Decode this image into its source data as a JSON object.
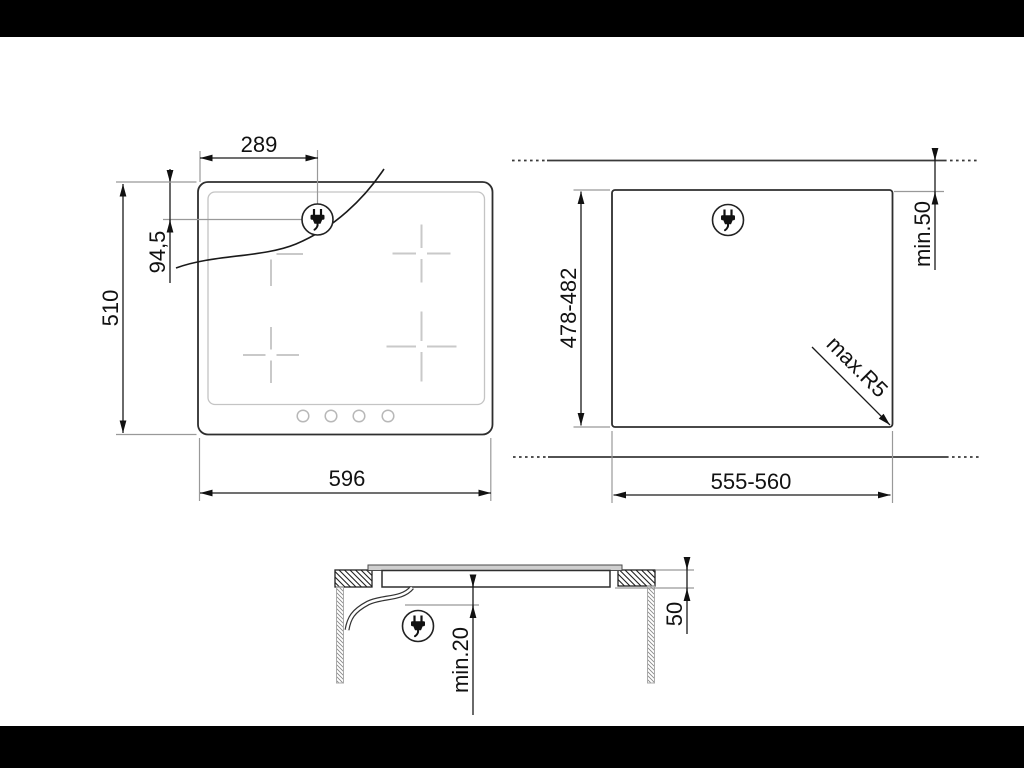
{
  "colors": {
    "ink": "#1a1a1a",
    "light_print_gray": "#c9c9c9",
    "extension_line_gray": "#999999",
    "glass_fill": "#cfcfcf",
    "letterbox": "#000000"
  },
  "icons": {
    "plug": "power-plug-icon"
  },
  "views": {
    "top": {
      "dims": {
        "plug_x": "289",
        "plug_y": "94,5",
        "height": "510",
        "width": "596"
      }
    },
    "cutout": {
      "dims": {
        "height": "478-482",
        "rear_clearance": "min.50",
        "corner_radius": "max.R5",
        "width": "555-560"
      }
    },
    "side": {
      "dims": {
        "bottom_clearance": "min.20",
        "recess_depth": "50"
      }
    }
  }
}
